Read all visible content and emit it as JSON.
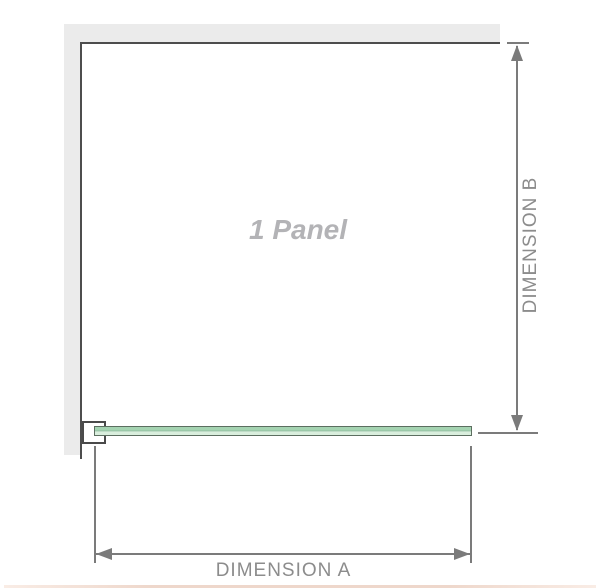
{
  "diagram": {
    "panel_label": "1 Panel",
    "dimension_a_label": "DIMENSION A",
    "dimension_b_label": "DIMENSION B"
  },
  "icons": {
    "dimension_a_left_arrow": "left-arrowhead-triangle",
    "dimension_a_right_arrow": "right-arrowhead-triangle",
    "dimension_b_up_arrow": "up-arrowhead-triangle",
    "dimension_b_down_arrow": "down-arrowhead-triangle"
  },
  "colors": {
    "wall_fill": "#ebebeb",
    "wall_edge": "#4d4d4d",
    "dimension_line": "#7b7b7b",
    "dimension_text": "#8c8c8c",
    "panel_label_text": "#b3b3b6",
    "glass_edge": "#5c6e60",
    "glass_fill_top": "#a4d3b1",
    "glass_fill_mid": "#82b092",
    "glass_fill_bottom": "#d9eedd",
    "bottom_band": "#eed7cb"
  }
}
